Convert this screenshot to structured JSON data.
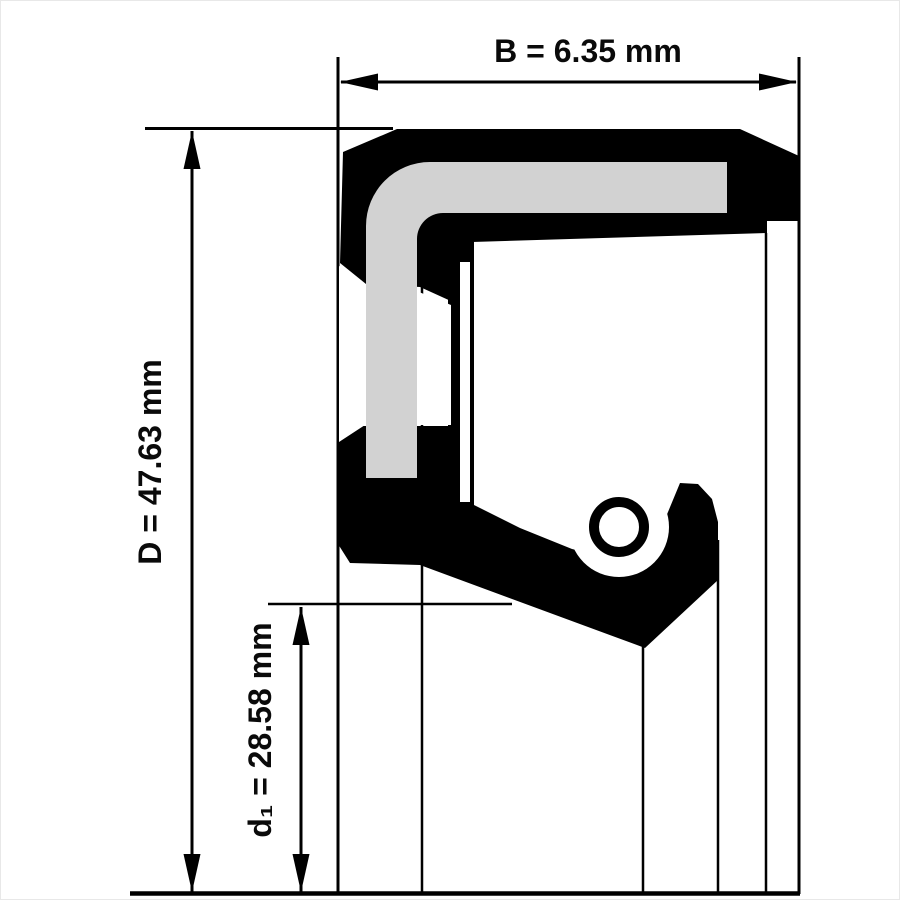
{
  "diagram": {
    "kind": "shaft-seal-cross-section",
    "dimensions": {
      "width_b": {
        "label": "B = 6.35 mm",
        "symbol": "B",
        "value": 6.35,
        "unit": "mm"
      },
      "outer_diameter_d": {
        "label": "D = 47.63 mm",
        "symbol": "D",
        "value": 47.63,
        "unit": "mm"
      },
      "inner_diameter_d1": {
        "label": "d₁ = 28.58 mm",
        "symbol": "d₁",
        "value": 28.58,
        "unit": "mm"
      }
    },
    "colors": {
      "line": "#000000",
      "body": "#000000",
      "insert": "#d2d2d2",
      "background": "#ffffff",
      "frame": "#e8e8e8"
    }
  }
}
